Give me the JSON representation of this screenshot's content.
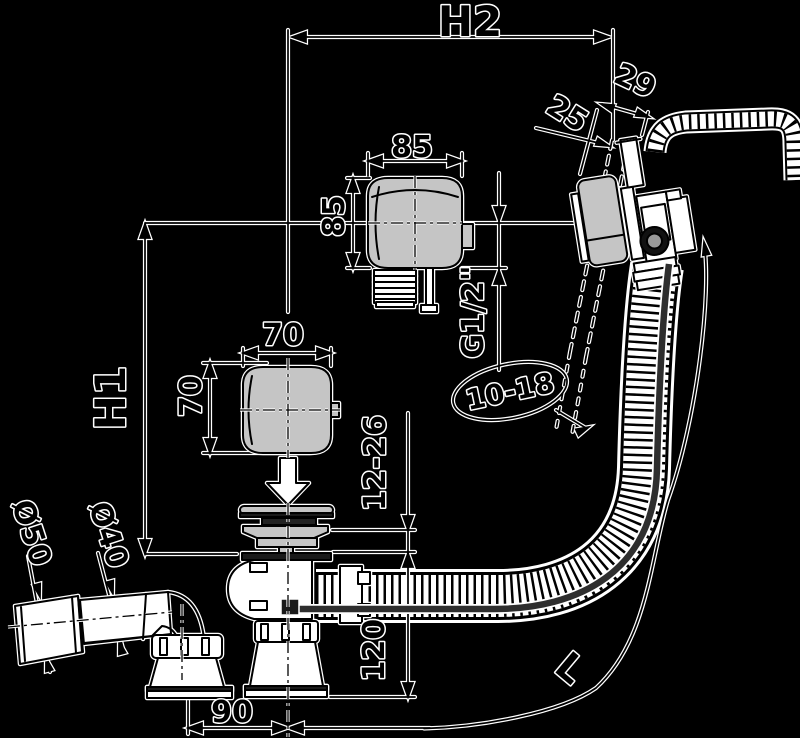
{
  "drawing": {
    "title": "bath-waste-overflow-filler-technical-drawing",
    "dims": {
      "h2": "H2",
      "h1": "H1",
      "w85": "85",
      "h85": "85",
      "thread": "G1/2\"",
      "w70": "70",
      "h70": "70",
      "wall_range": "10-18",
      "d25": "25",
      "d29": "29",
      "plug_gap": "12-26",
      "h120": "120",
      "w90": "90",
      "d50": "Ø50",
      "d40": "Ø40",
      "hose_length": "L"
    },
    "colors": {
      "background": "#000000",
      "line": "#000000",
      "halo": "#ffffff",
      "part_fill": "#c5c5c5",
      "dark_fill": "#1a1a1a",
      "cable": "#2e2e2e",
      "ring_inner": "#999999"
    }
  }
}
